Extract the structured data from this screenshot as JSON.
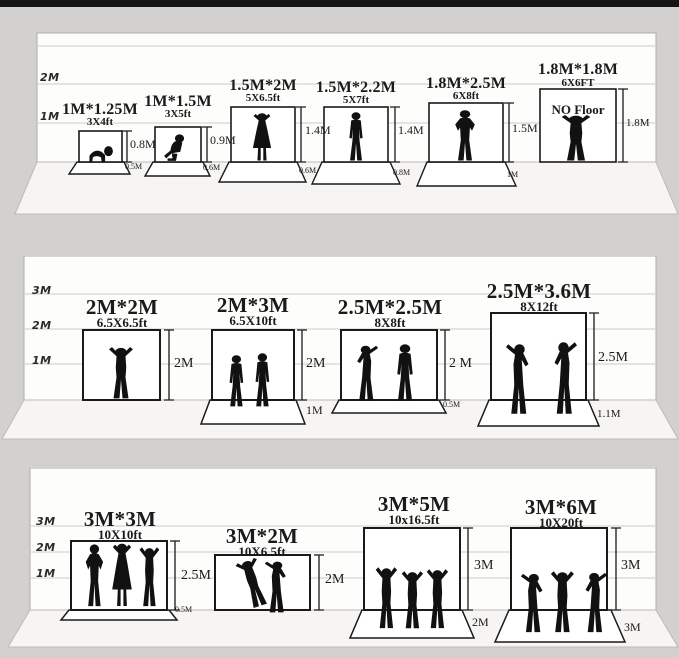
{
  "colors": {
    "background": "#d4d3d1",
    "wall": "#fdfdfc",
    "floor": "#f5f4f2",
    "line": "#1a1a1a",
    "grid": "#cdccc9",
    "top_bar": "#141414"
  },
  "panels": [
    {
      "name": "backdrops-1m-to-1.8m",
      "scale_labels": [
        "2M",
        "1M"
      ],
      "items": [
        {
          "title": "1M*1.25M",
          "subtitle": "3X4ft",
          "height_label": "0.8M",
          "floor_label": "0.5M",
          "figure": "crawling-baby"
        },
        {
          "title": "1M*1.5M",
          "subtitle": "3X5ft",
          "height_label": "0.9M",
          "floor_label": "0.6M",
          "figure": "sitting-child"
        },
        {
          "title": "1.5M*2M",
          "subtitle": "5X6.5ft",
          "height_label": "1.4M",
          "floor_label": "0.6M",
          "figure": "woman-arms-raised"
        },
        {
          "title": "1.5M*2.2M",
          "subtitle": "5X7ft",
          "height_label": "1.4M",
          "floor_label": "0.8M",
          "figure": "standing-man"
        },
        {
          "title": "1.8M*2.5M",
          "subtitle": "6X8ft",
          "height_label": "1.5M",
          "floor_label": "1M",
          "figure": "man-hands-on-hips"
        },
        {
          "title": "1.8M*1.8M",
          "subtitle": "6X6FT",
          "height_label": "1.8M",
          "note": "NO Floor",
          "figure": "man-arms-raised"
        }
      ]
    },
    {
      "name": "backdrops-2m-to-2.5m",
      "scale_labels": [
        "3M",
        "2M",
        "1M"
      ],
      "items": [
        {
          "title": "2M*2M",
          "subtitle": "6.5X6.5ft",
          "height_label": "2M",
          "figure": "man-arms-raised"
        },
        {
          "title": "2M*3M",
          "subtitle": "6.5X10ft",
          "height_label": "2M",
          "floor_label": "1M",
          "figure": "two-standing-men"
        },
        {
          "title": "2.5M*2.5M",
          "subtitle": "8X8ft",
          "height_label": "2 M",
          "floor_label": "0.5M",
          "figure": "two-men-talking"
        },
        {
          "title": "2.5M*3.6M",
          "subtitle": "8X12ft",
          "height_label": "2.5M",
          "floor_label": "1.1M",
          "figure": "two-men-gesturing"
        }
      ]
    },
    {
      "name": "backdrops-3m",
      "scale_labels": [
        "3M",
        "2M",
        "1M"
      ],
      "items": [
        {
          "title": "3M*3M",
          "subtitle": "10X10ft",
          "height_label": "2.5M",
          "floor_label": "0.5M",
          "figure": "three-people-group"
        },
        {
          "title": "3M*2M",
          "subtitle": "10X6.5ft",
          "height_label": "2M",
          "figure": "two-dancers"
        },
        {
          "title": "3M*5M",
          "subtitle": "10x16.5ft",
          "height_label": "3M",
          "floor_label": "2M",
          "figure": "three-cheering-people"
        },
        {
          "title": "3M*6M",
          "subtitle": "10X20ft",
          "height_label": "3M",
          "floor_label": "3M",
          "figure": "band-performers"
        }
      ]
    }
  ]
}
